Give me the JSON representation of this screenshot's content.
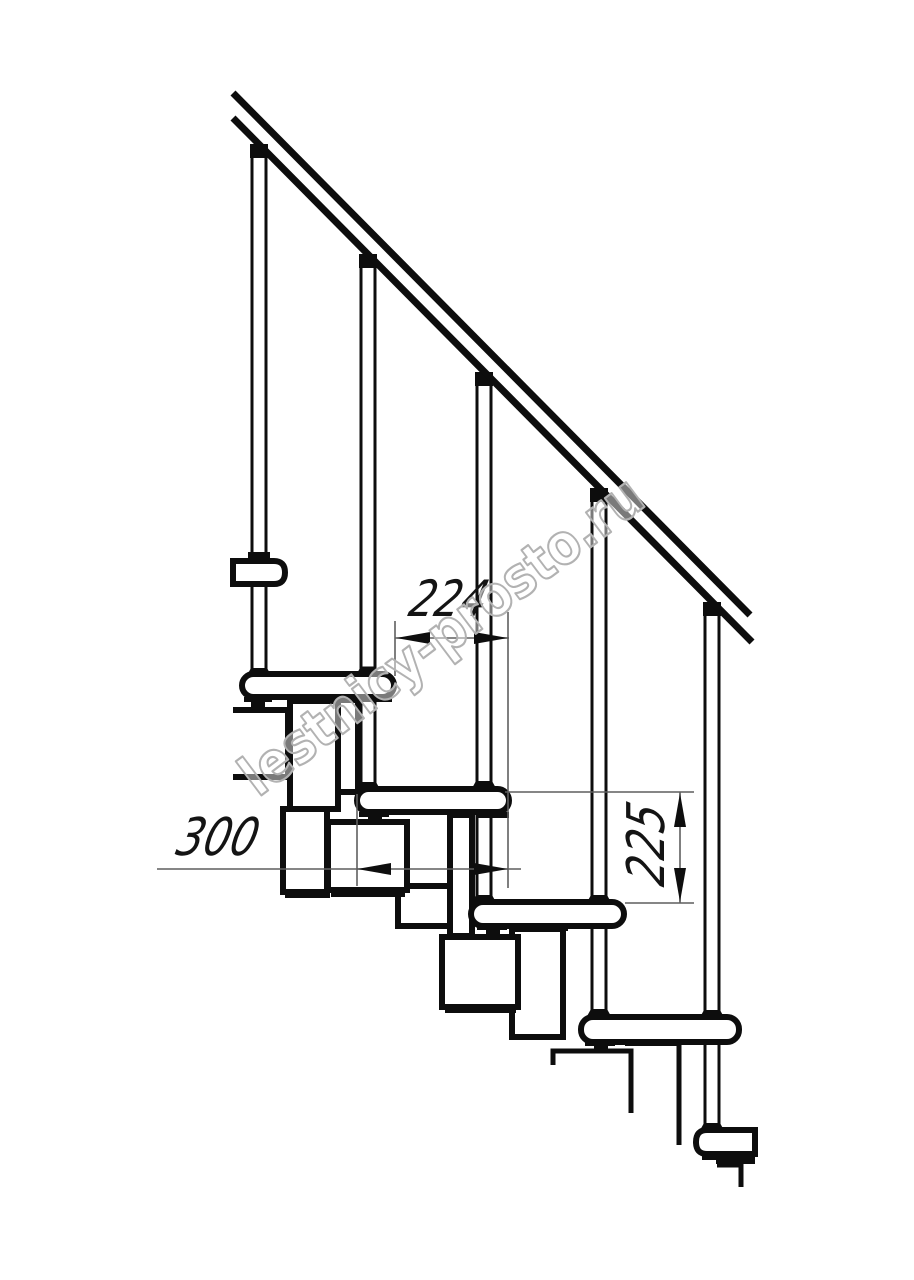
{
  "drawing": {
    "kind": "staircase side-view technical drawing",
    "line_color": "#0d0d0d",
    "background": "#ffffff"
  },
  "dimensions": {
    "run": {
      "value": "224"
    },
    "tread_depth": {
      "value": "300"
    },
    "rise": {
      "value": "225"
    }
  },
  "watermark": {
    "text": "lestnicy-prosto.ru",
    "color": "#b2b2b2"
  }
}
